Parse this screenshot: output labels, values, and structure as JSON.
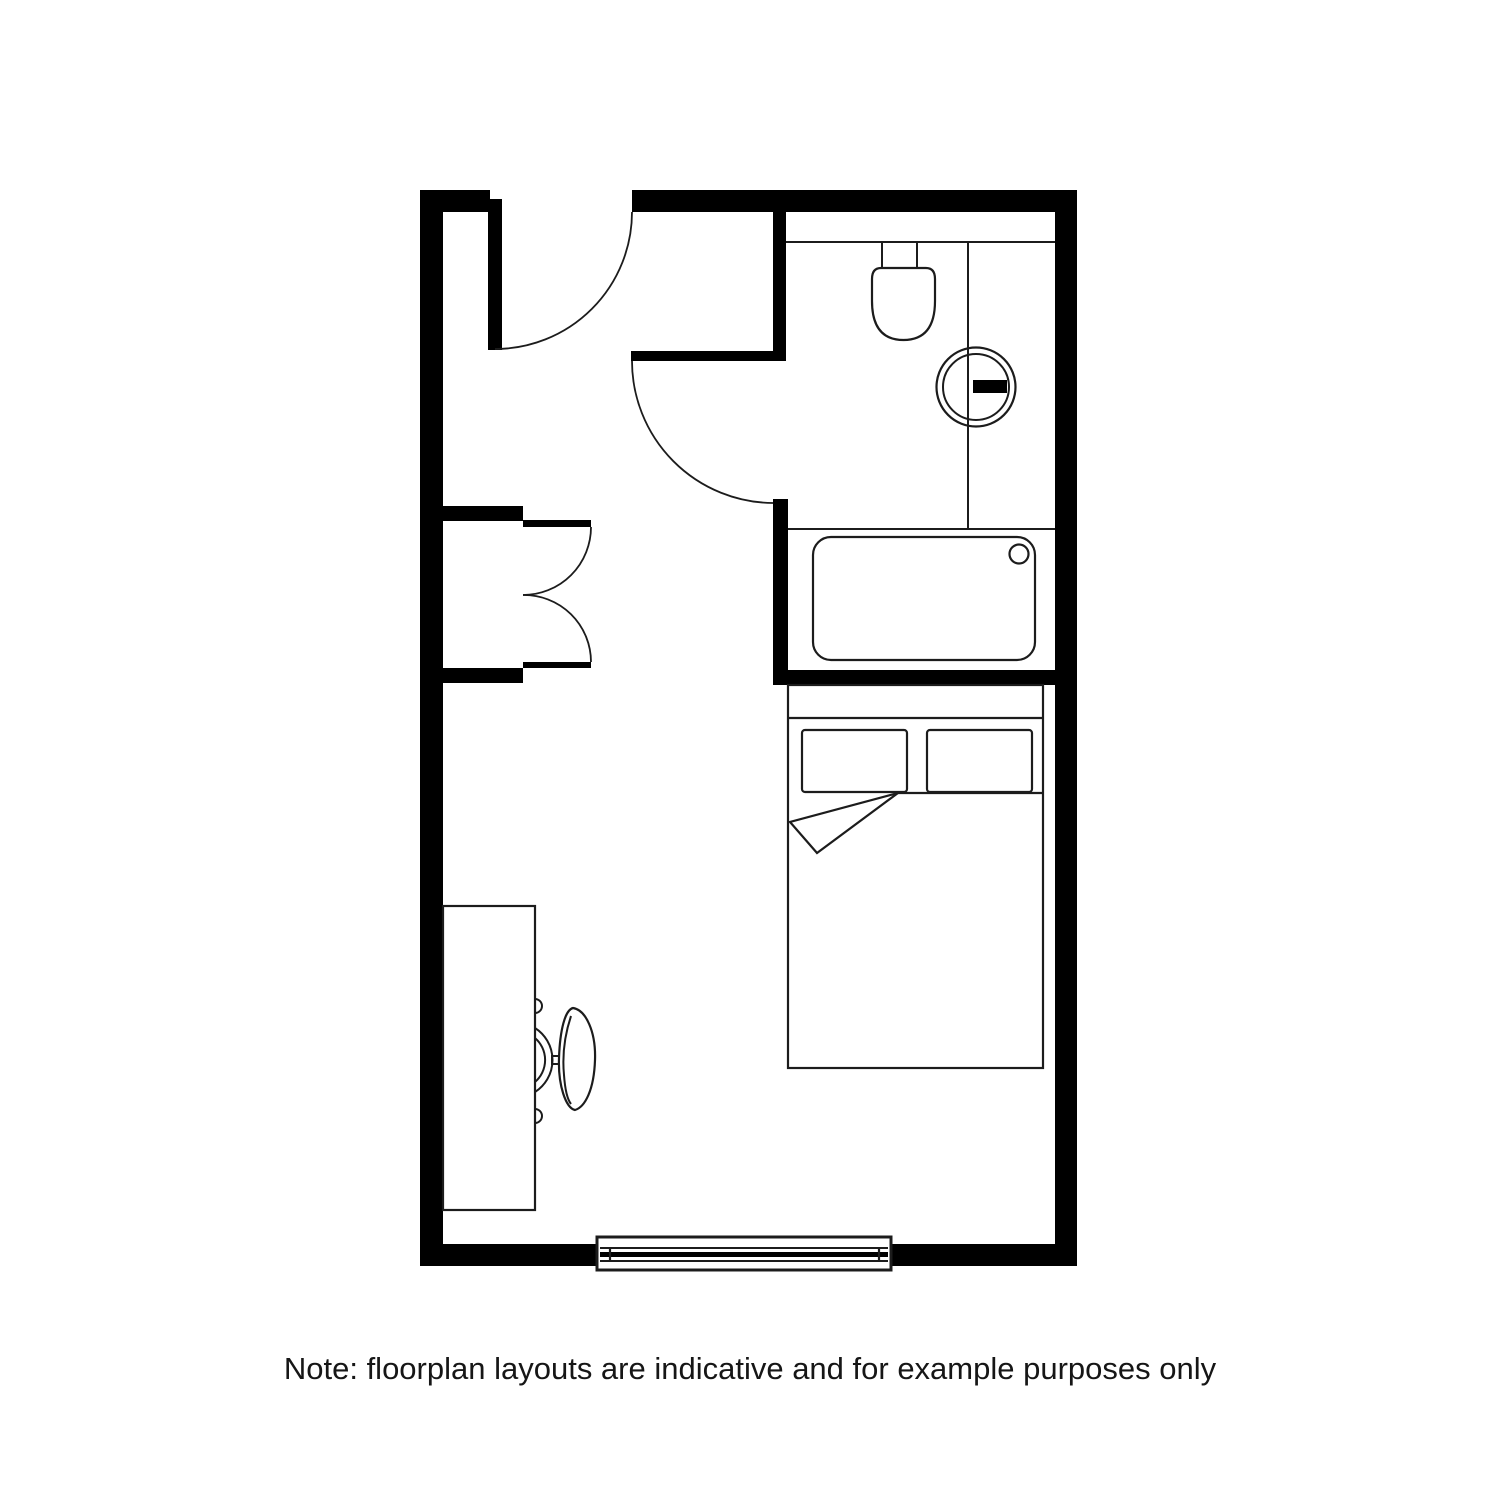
{
  "canvas": {
    "width": 1500,
    "height": 1500,
    "background": "#ffffff"
  },
  "colors": {
    "wall": "#000000",
    "line": "#1c1c1c",
    "note_text": "#161616"
  },
  "note": {
    "text": "Note: floorplan layouts are indicative and for example purposes only"
  },
  "floorplan": {
    "type": "studio-room-floorplan",
    "fixtures": [
      "entry-door",
      "bathroom-door",
      "wardrobe-double-doors",
      "toilet",
      "basin-with-tap",
      "shower-tray-with-drain",
      "double-bed",
      "pillows",
      "duvet-fold",
      "desk",
      "desk-chair",
      "window"
    ]
  }
}
